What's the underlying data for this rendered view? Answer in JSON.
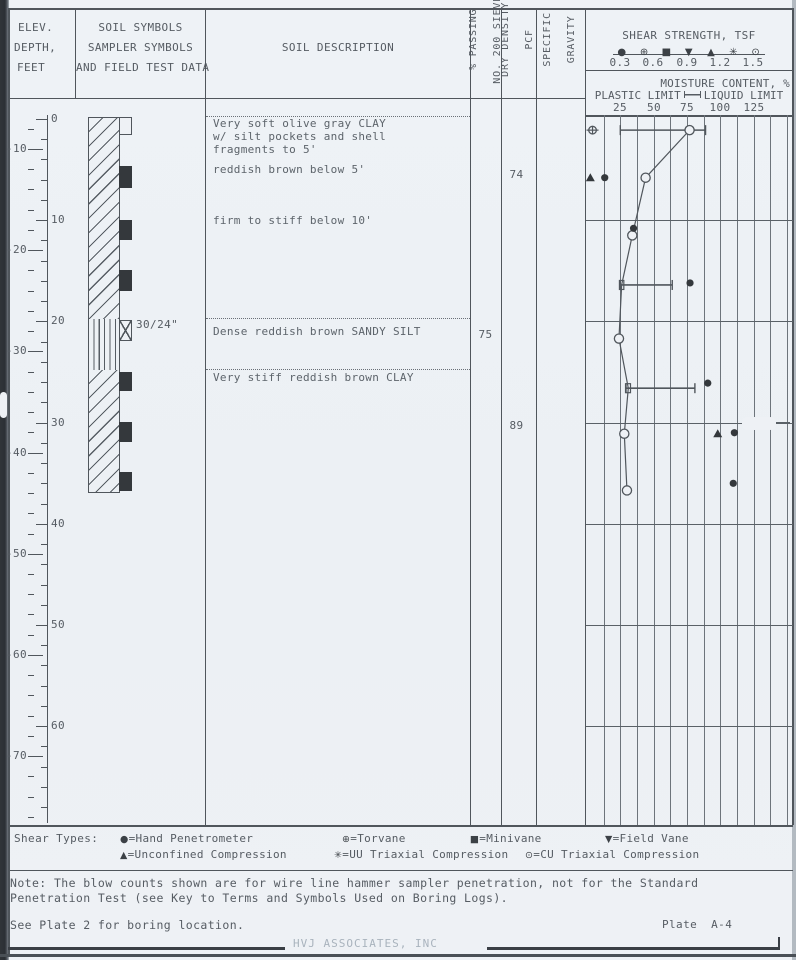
{
  "header": {
    "elev": [
      "ELEV.",
      "DEPTH,",
      "FEET"
    ],
    "symbols_col": [
      "SOIL SYMBOLS",
      "SAMPLER SYMBOLS",
      "AND FIELD TEST DATA"
    ],
    "description_col": "SOIL DESCRIPTION",
    "passing_col": [
      "% PASSING",
      "NO. 200 SIEVE"
    ],
    "density_col": [
      "DRY DENSITY",
      "PCF"
    ],
    "gravity_col": [
      "SPECIFIC",
      "GRAVITY"
    ]
  },
  "shear_axis": {
    "title": "SHEAR STRENGTH, TSF",
    "symbols": [
      "●",
      "⊕",
      "■",
      "▼",
      "▲",
      "✳",
      "⊙"
    ],
    "ticks": [
      "0.3",
      "0.6",
      "0.9",
      "1.2",
      "1.5"
    ]
  },
  "moisture_axis": {
    "title": "MOISTURE CONTENT, %",
    "plastic_label": "PLASTIC LIMIT",
    "liquid_label": "LIQUID LIMIT",
    "ticks": [
      "25",
      "50",
      "75",
      "100",
      "125"
    ]
  },
  "scale": {
    "depth_labels": [
      0,
      10,
      20,
      30,
      40,
      50,
      60
    ],
    "elevation_labels": [
      -10,
      -20,
      -30,
      -40,
      -50,
      -60,
      -70
    ],
    "ground_offset_ft": 7.04
  },
  "layers": [
    {
      "pattern": "clay",
      "top_ft": 0,
      "bottom_ft": 20,
      "descriptions": [
        {
          "ft": 0.4,
          "lines": [
            "Very soft olive gray CLAY",
            "w/ silt pockets and shell",
            "fragments to 5'"
          ]
        },
        {
          "ft": 4.9,
          "lines": [
            "reddish brown below 5'"
          ]
        },
        {
          "ft": 10.0,
          "lines": [
            "firm to stiff below 10'"
          ]
        }
      ]
    },
    {
      "pattern": "silt",
      "top_ft": 20,
      "bottom_ft": 25,
      "descriptions": [
        {
          "ft": 20.9,
          "lines": [
            "Dense reddish brown SANDY SILT"
          ]
        }
      ]
    },
    {
      "pattern": "clay",
      "top_ft": 25,
      "bottom_ft": 37.2,
      "descriptions": [
        {
          "ft": 25.5,
          "lines": [
            "Very stiff reddish brown CLAY"
          ]
        }
      ]
    }
  ],
  "samplers": [
    {
      "type": "open",
      "top_ft": 0.0,
      "bottom_ft": 1.8,
      "label": ""
    },
    {
      "type": "filled",
      "top_ft": 4.8,
      "bottom_ft": 7.0,
      "label": ""
    },
    {
      "type": "filled",
      "top_ft": 10.2,
      "bottom_ft": 12.2,
      "label": ""
    },
    {
      "type": "filled",
      "top_ft": 15.1,
      "bottom_ft": 17.2,
      "label": ""
    },
    {
      "type": "xbox",
      "top_ft": 20.1,
      "bottom_ft": 22.1,
      "label": "30/24\""
    },
    {
      "type": "filled",
      "top_ft": 25.2,
      "bottom_ft": 27.1,
      "label": ""
    },
    {
      "type": "filled",
      "top_ft": 30.1,
      "bottom_ft": 32.1,
      "label": ""
    },
    {
      "type": "filled",
      "top_ft": 35.1,
      "bottom_ft": 37.0,
      "label": ""
    }
  ],
  "lab_values": [
    {
      "column": "density",
      "ft": 5.4,
      "value": "74"
    },
    {
      "column": "passing",
      "ft": 21.2,
      "value": "75"
    },
    {
      "column": "density",
      "ft": 30.2,
      "value": "89"
    }
  ],
  "chart_data": {
    "type": "scatter",
    "title": "SHEAR STRENGTH, TSF (0.3-1.5) and MOISTURE CONTENT, % (25-125) vs depth, ft",
    "moisture_axis_range": [
      0,
      150
    ],
    "moisture_gridline_step": 12.5,
    "shear_axis_range": [
      0,
      1.8
    ],
    "depth_gridlines_ft": [
      10,
      20,
      30,
      40,
      50,
      60
    ],
    "moisture_profile": [
      {
        "ft": 1.1,
        "w": 77,
        "marker": "circle"
      },
      {
        "ft": 5.8,
        "w": 44,
        "marker": "circle"
      },
      {
        "ft": 11.5,
        "w": 34,
        "marker": "circle"
      },
      {
        "ft": 16.4,
        "w": 26,
        "marker": "tick"
      },
      {
        "ft": 21.7,
        "w": 24,
        "marker": "circle"
      },
      {
        "ft": 26.6,
        "w": 31,
        "marker": "tick"
      },
      {
        "ft": 31.1,
        "w": 28,
        "marker": "circle"
      },
      {
        "ft": 36.7,
        "w": 30,
        "marker": "circle"
      }
    ],
    "atterberg_bars": [
      {
        "ft": 1.1,
        "plastic_limit": 25,
        "liquid_limit": 89
      },
      {
        "ft": 16.4,
        "plastic_limit": 25,
        "liquid_limit": 64
      },
      {
        "ft": 26.6,
        "plastic_limit": 29,
        "liquid_limit": 81
      }
    ],
    "shear_points": [
      {
        "ft": 1.1,
        "tsf": 0.05,
        "type": "torvane"
      },
      {
        "ft": 5.8,
        "tsf": 0.03,
        "type": "unconfined"
      },
      {
        "ft": 5.8,
        "tsf": 0.16,
        "type": "hand-penetrometer"
      },
      {
        "ft": 10.8,
        "tsf": 0.42,
        "type": "hand-penetrometer"
      },
      {
        "ft": 16.2,
        "tsf": 0.93,
        "type": "hand-penetrometer"
      },
      {
        "ft": 26.1,
        "tsf": 1.09,
        "type": "hand-penetrometer"
      },
      {
        "ft": 31.1,
        "tsf": 1.18,
        "type": "unconfined"
      },
      {
        "ft": 31.0,
        "tsf": 1.33,
        "type": "hand-penetrometer"
      },
      {
        "ft": 36.0,
        "tsf": 1.32,
        "type": "hand-penetrometer"
      }
    ]
  },
  "legend": {
    "label": "Shear Types:",
    "row1": [
      {
        "symbol": "●",
        "name": "Hand Penetrometer"
      },
      {
        "symbol": "⊕",
        "name": "Torvane"
      },
      {
        "symbol": "■",
        "name": "Minivane"
      },
      {
        "symbol": "▼",
        "name": "Field Vane"
      }
    ],
    "row2": [
      {
        "symbol": "▲",
        "name": "Unconfined Compression"
      },
      {
        "symbol": "✳",
        "name": "UU Triaxial Compression"
      },
      {
        "symbol": "⊙",
        "name": "CU Triaxial Compression"
      }
    ]
  },
  "notes": {
    "line1": "Note: The blow counts shown are for wire line hammer sampler penetration, not for the Standard",
    "line2": "Penetration Test (see Key to Terms and Symbols Used on Boring Logs).",
    "see_plate": "See Plate 2 for boring location.",
    "plate": "Plate  A-4",
    "watermark": "HVJ ASSOCIATES, INC"
  },
  "colors": {
    "paper": "#eef1f5",
    "line": "#50565c",
    "text": "#565c63",
    "dark_fill": "#34383c",
    "faint": "#a9b3bd"
  }
}
